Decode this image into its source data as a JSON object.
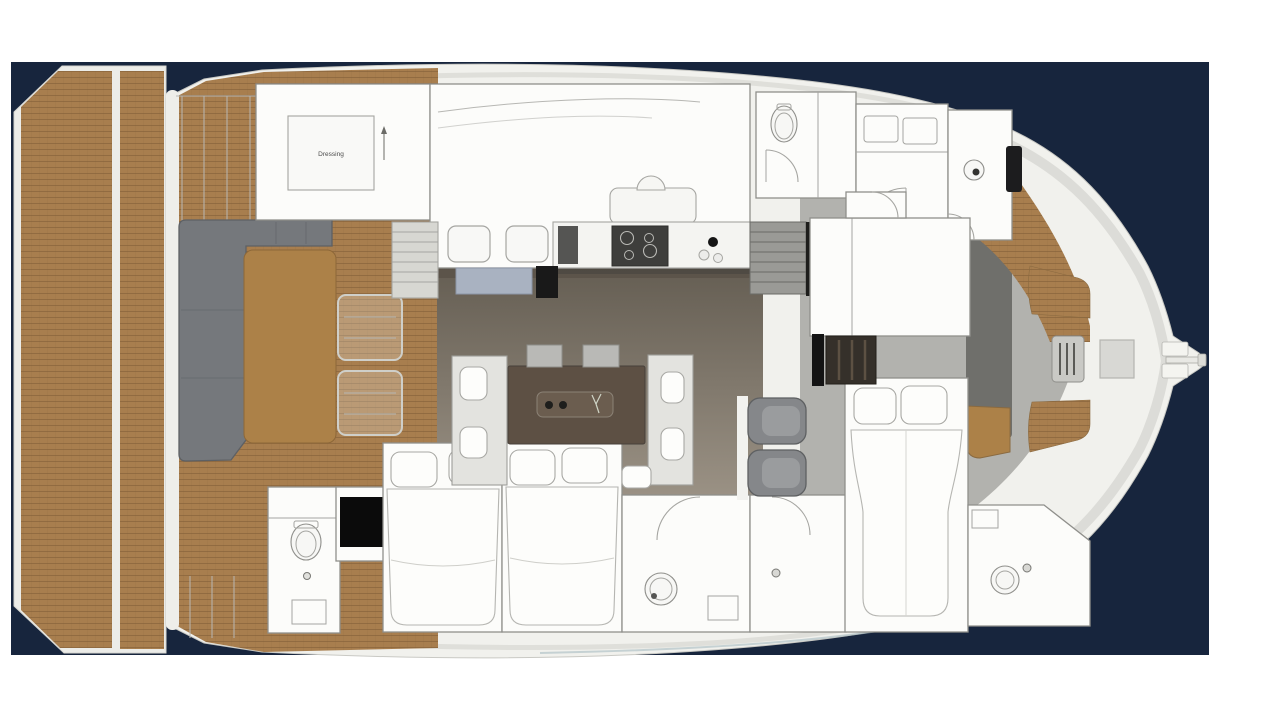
{
  "background": {
    "page": "#ffffff",
    "water": "#17253d"
  },
  "palette": {
    "hull": "#f1f1ed",
    "hullEdge": "#c9c9c4",
    "teak": "#a87e4e",
    "teakLine": "#7e5a36",
    "cabin": "#fcfcfa",
    "outline": "#8f8f8b",
    "innerLine": "#a5a5a1",
    "sofa": "#75787c",
    "sofaDark": "#5d6064",
    "tableWood": "#ac8148",
    "diningTable": "#5d5044",
    "floorDark": "#655e53",
    "floorLight": "#9a9184",
    "grayFloor": "#a8a8a4",
    "bowDeck": "#b2b2ae",
    "darkWall": "#6f6f6b",
    "seatGray": "#85878a",
    "benchBlue": "#a9b2c1",
    "black": "#0b0b0b",
    "bed": "#fdfdfb"
  },
  "labels": {
    "dressing": "Dressing"
  }
}
